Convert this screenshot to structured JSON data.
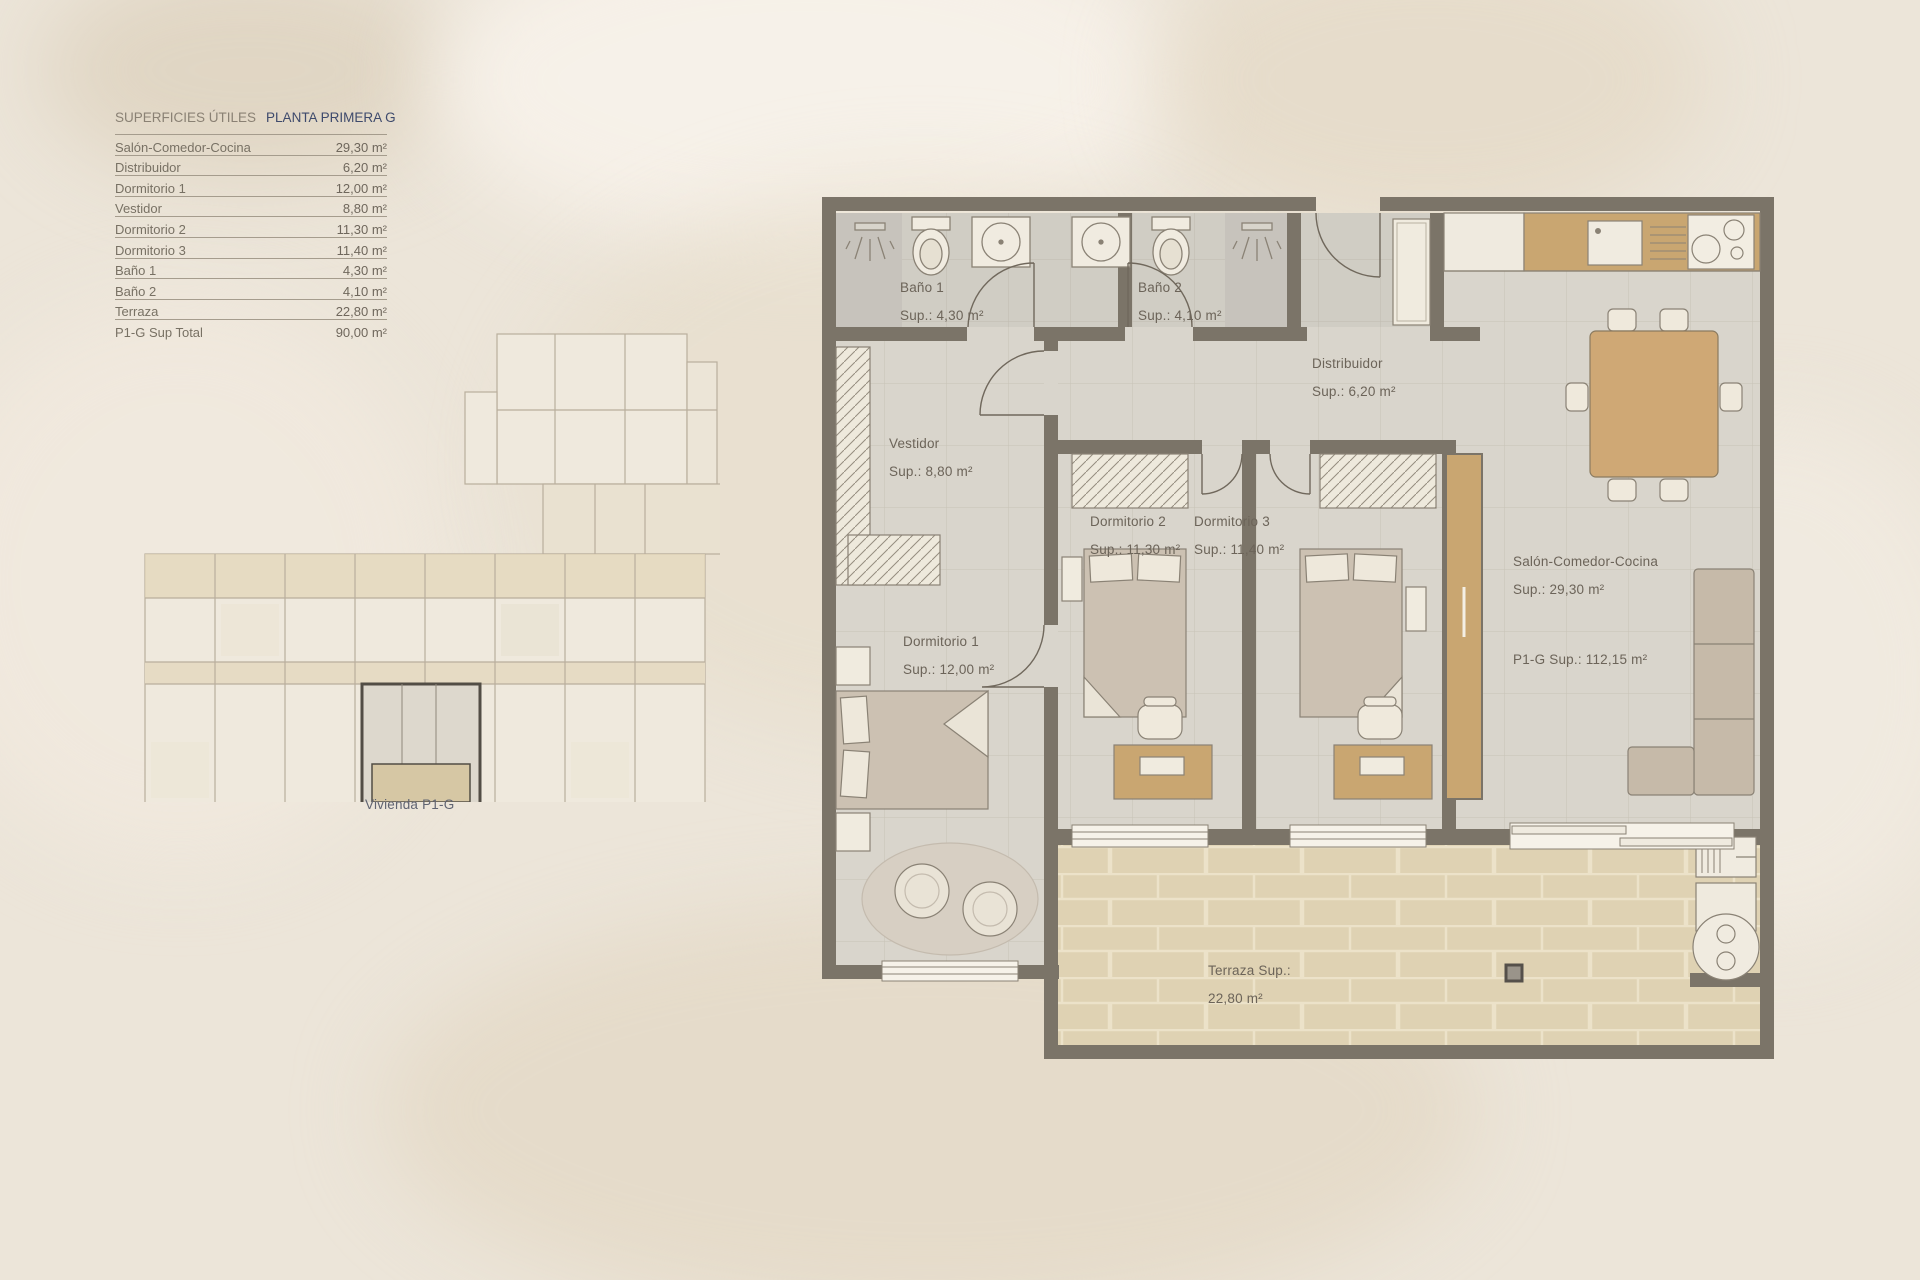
{
  "table": {
    "header": {
      "left": "SUPERFICIES ÚTILES",
      "right": "PLANTA PRIMERA G"
    },
    "rows": [
      {
        "label": "Salón-Comedor-Cocina",
        "value": "29,30 m²"
      },
      {
        "label": "Distribuidor",
        "value": "6,20 m²"
      },
      {
        "label": "Dormitorio 1",
        "value": "12,00 m²"
      },
      {
        "label": "Vestidor",
        "value": "8,80 m²"
      },
      {
        "label": "Dormitorio 2",
        "value": "11,30 m²"
      },
      {
        "label": "Dormitorio 3",
        "value": "11,40 m²"
      },
      {
        "label": "Baño 1",
        "value": "4,30 m²"
      },
      {
        "label": "Baño 2",
        "value": "4,10 m²"
      },
      {
        "label": "Terraza",
        "value": "22,80 m²"
      },
      {
        "label": "P1-G Sup Total",
        "value": "90,00 m²"
      }
    ]
  },
  "overview": {
    "caption": "Vivienda P1-G"
  },
  "plan": {
    "rooms": [
      {
        "id": "bano1",
        "name": "Baño 1",
        "sup": "Sup.: 4,30 m²"
      },
      {
        "id": "bano2",
        "name": "Baño 2",
        "sup": "Sup.: 4,10 m²"
      },
      {
        "id": "distribuidor",
        "name": "Distribuidor",
        "sup": "Sup.: 6,20 m²"
      },
      {
        "id": "vestidor",
        "name": "Vestidor",
        "sup": "Sup.: 8,80 m²"
      },
      {
        "id": "dormitorio1",
        "name": "Dormitorio 1",
        "sup": "Sup.: 12,00 m²"
      },
      {
        "id": "dormitorio2",
        "name": "Dormitorio 2",
        "sup": "Sup.: 11,30 m²"
      },
      {
        "id": "dormitorio3",
        "name": "Dormitorio 3",
        "sup": "Sup.: 11,40 m²"
      },
      {
        "id": "salon",
        "name": "Salón-Comedor-Cocina",
        "sup": "Sup.: 29,30 m²",
        "total": "P1-G Sup.: 112,15 m²"
      },
      {
        "id": "terraza",
        "name": "Terraza Sup.:",
        "sup": "22,80 m²"
      }
    ],
    "colors": {
      "wall": "#7b7468",
      "wood": "#c9a671",
      "terrace": "#dfd2b3",
      "floor": "#d9d5cc",
      "accent_navy": "#3e4a6c"
    }
  }
}
